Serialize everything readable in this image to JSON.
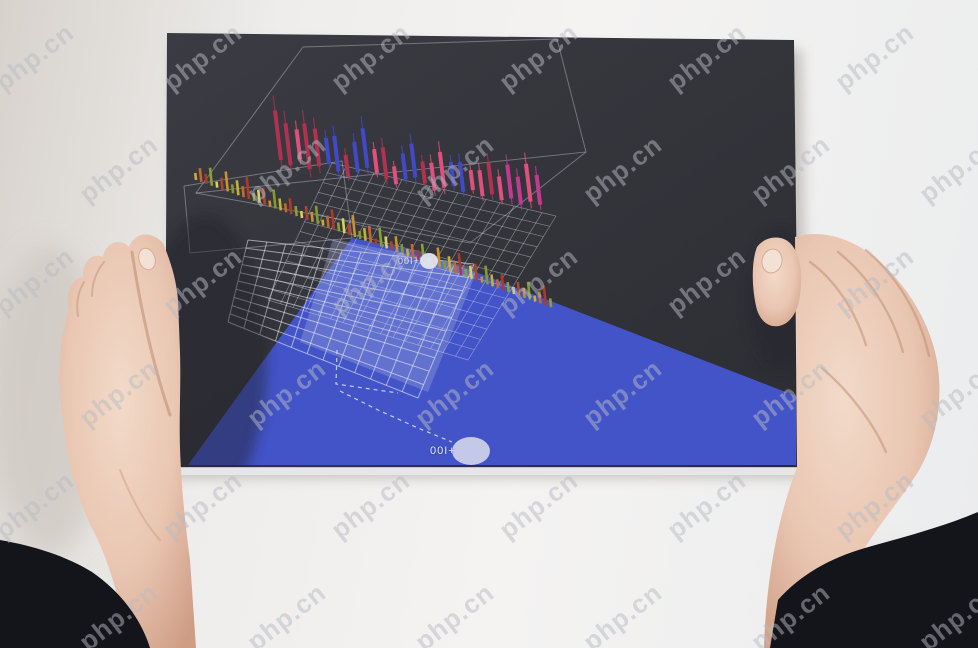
{
  "page": {
    "type": "photograph",
    "alt": "Two hands holding a dark poster card printed with a 3D-perspective candlestick stock chart, wireframe grids and a blue wedge overlay"
  },
  "watermark": {
    "text": "php.cn",
    "color": "#b9bac2",
    "opacity": 0.5,
    "font_size": 26,
    "rotation_deg": -38,
    "step_x": 168,
    "step_y": 112,
    "row_offset_x": 84
  },
  "markers": [
    {
      "label": "00I+",
      "cx": 429,
      "cy": 261,
      "rx": 9,
      "ry": 8,
      "fill": "#e2e4ee"
    },
    {
      "label": "00I+",
      "cx": 471,
      "cy": 451,
      "rx": 19,
      "ry": 14,
      "fill": "#ccd0ea"
    }
  ],
  "artwork": {
    "card": {
      "corners": "167,33 794,40 799,467 165,467",
      "shadow": "172,42 802,50 808,478 170,478",
      "edge_strip": "165,468 799,468 799,475 165,475",
      "gradient": [
        "#3b3b43",
        "#33333a",
        "#2c2c33"
      ]
    },
    "blue_wedge": {
      "points": "188,465 352,238 412,250 473,271 796,396 796,465",
      "color": "#4354c8"
    },
    "overlay_panel": {
      "points": "333,239 478,268 428,392 300,342",
      "color": "rgba(168,176,224,0.32)"
    },
    "wireframes": {
      "stroke": "rgba(205,206,218,0.42)",
      "polys": [
        "303,47 557,39 586,152 196,193 303,47",
        "184,186 342,161 352,238 190,253 184,186",
        "196,193 470,243 586,152"
      ]
    },
    "grids": [
      {
        "quad": [
          [
            332,
            163
          ],
          [
            556,
            216
          ],
          [
            468,
            360
          ],
          [
            268,
            300
          ]
        ],
        "nx": 16,
        "ny": 14,
        "stroke": "rgba(225,228,240,0.45)",
        "w": 0.7
      },
      {
        "quad": [
          [
            248,
            240
          ],
          [
            474,
            264
          ],
          [
            418,
            398
          ],
          [
            228,
            322
          ]
        ],
        "nx": 12,
        "ny": 10,
        "stroke": "rgba(232,235,247,0.6)",
        "w": 1
      }
    ],
    "candles": {
      "x0": 281,
      "dx": 9.6,
      "base_y": 160,
      "drift": 1.1,
      "width": 4,
      "lean_deg": -7,
      "palette": [
        "#b23050",
        "#e0507e",
        "#4149c8",
        "#c23a90"
      ],
      "heights": [
        50,
        42,
        30,
        46,
        38,
        26,
        36,
        22,
        30,
        40,
        24,
        32,
        18,
        26,
        34,
        22,
        28,
        36,
        24,
        30,
        20,
        26,
        32,
        24,
        34,
        28,
        38,
        30
      ],
      "colors": [
        0,
        0,
        1,
        0,
        0,
        2,
        2,
        0,
        2,
        2,
        1,
        0,
        1,
        2,
        2,
        0,
        1,
        1,
        2,
        2,
        1,
        1,
        0,
        1,
        3,
        3,
        1,
        3
      ],
      "wobble": [
        0,
        4,
        -3,
        6,
        2,
        -2,
        5,
        9,
        3,
        -2,
        2,
        7,
        11,
        5,
        2,
        7,
        13,
        9,
        6,
        11,
        8,
        13,
        10,
        15,
        12,
        17,
        13,
        15
      ]
    },
    "volume_bars": {
      "x0": 196,
      "dx": 5.3,
      "base_y": 180,
      "drift": 1.9,
      "width": 2.6,
      "count": 68,
      "lean_deg": -6,
      "heights_cycle": [
        7,
        14,
        10,
        18,
        6,
        12,
        20,
        9,
        15,
        11,
        22,
        8,
        13,
        17,
        6,
        19,
        12,
        9,
        16,
        10
      ],
      "colors_cycle": [
        "#c9ae36",
        "#c4682c",
        "#b03a2a",
        "#8aa034",
        "#d8d058",
        "#b0442e",
        "#c7922f",
        "#7f9c33"
      ]
    },
    "dashed_guides": {
      "stroke": "#dfe3f2",
      "polys": [
        "337,350 336,384 398,393",
        "340,391 378,410 418,428 452,442"
      ]
    },
    "card_shading": [
      {
        "cx": 205,
        "cy": 360,
        "rx": 62,
        "ry": 145,
        "fill": "#24242a",
        "opacity": 0.45
      },
      {
        "cx": 782,
        "cy": 300,
        "rx": 34,
        "ry": 70,
        "fill": "#24242a",
        "opacity": 0.35
      }
    ],
    "hands": {
      "skin_base": "#e9c6b2",
      "skin_light": "#f2dac9",
      "skin_dark": "#cf9d84",
      "crease": "#c08a6e",
      "nail": "#f2e1d5",
      "sleeve": "#14141b",
      "left_hand_path": "M163,243 C152,231 135,231 129,247 C121,238 106,241 103,257 C93,252 82,261 83,277 C72,279 65,293 69,310 C60,338 57,376 62,412 C66,452 76,500 96,536 C110,565 122,606 128,648 L196,648 L190,560 C184,516 181,478 180,448 C179,414 181,388 180,352 L178,300 C176,276 169,258 163,243 Z",
      "left_thumb_crease": "M132,252 C140,305 152,362 170,415",
      "left_knuckle_1": "M104,262 C96,272 92,284 92,296",
      "left_knuckle_2": "M84,282 C78,292 76,304 78,316",
      "left_palm_line": "M120,470 C132,500 146,525 160,540",
      "left_nail": {
        "cx": 147,
        "cy": 259,
        "rx": 8,
        "ry": 11,
        "rot": -18
      },
      "right_hand_path": "M795,237 C824,228 856,240 880,262 C908,287 928,320 936,356 C944,395 938,438 918,472 C898,504 872,532 857,562 C847,592 841,620 839,648 L764,648 C766,585 776,522 797,467 Z",
      "right_thumb_path": "M757,247 C765,236 782,234 791,244 C800,254 803,274 800,295 C798,312 790,324 779,326 C768,328 759,320 756,306 C752,288 751,262 757,247 Z",
      "right_nail": {
        "cx": 772,
        "cy": 261,
        "rx": 10,
        "ry": 12,
        "rot": 14
      },
      "right_creases": [
        "M810,262 C835,280 855,310 866,345",
        "M838,252 C868,276 892,312 903,352",
        "M866,250 C897,276 920,314 929,356",
        "M822,368 C850,392 874,424 886,452"
      ],
      "left_sleeve_path": "M0,540 C34,546 66,556 92,572 C118,590 140,616 150,648 L0,648 Z",
      "right_sleeve_path": "M770,648 L778,600 C800,575 830,558 865,548 C900,538 940,528 978,512 L978,648 Z"
    },
    "bg_shadows": [
      {
        "cx": 50,
        "cy": 400,
        "rx": 58,
        "ry": 155,
        "fill": "#cdc7c0",
        "opacity": 0.7
      },
      {
        "cx": 905,
        "cy": 612,
        "rx": 95,
        "ry": 62,
        "fill": "#d5d0ca",
        "opacity": 0.8
      }
    ]
  }
}
